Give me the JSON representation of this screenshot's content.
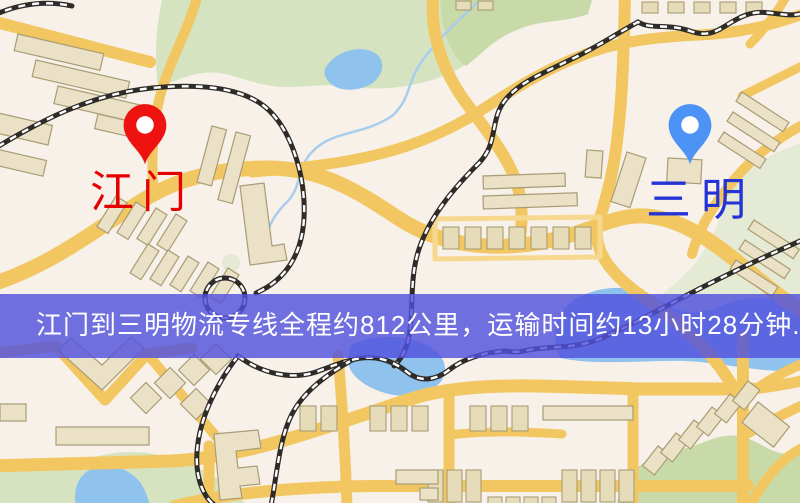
{
  "map": {
    "colors": {
      "background": "#f7f1ea",
      "road": "#f2c761",
      "road_minor": "#f6d98e",
      "building": "#eae1c6",
      "building_stroke": "#a89d74",
      "park": "#d6e3c1",
      "park_dark": "#c9daa9",
      "water": "#8fc2ec",
      "railway": "#2e2b28"
    },
    "origin": {
      "label": "江门",
      "label_color": "#e60000",
      "pin_color": "#ee1310",
      "icon": "location-pin-icon"
    },
    "destination": {
      "label": "三明",
      "label_color": "#2433d6",
      "pin_color": "#4d93f6",
      "icon": "location-pin-icon"
    },
    "banner": {
      "text": "江门到三明物流专线全程约812公里，运输时间约13小时28分钟.",
      "bg_color": "rgba(82,82,222,0.82)",
      "text_color": "#ffffff",
      "distance_text": "812公里",
      "duration_text": "13小时28分钟"
    }
  }
}
